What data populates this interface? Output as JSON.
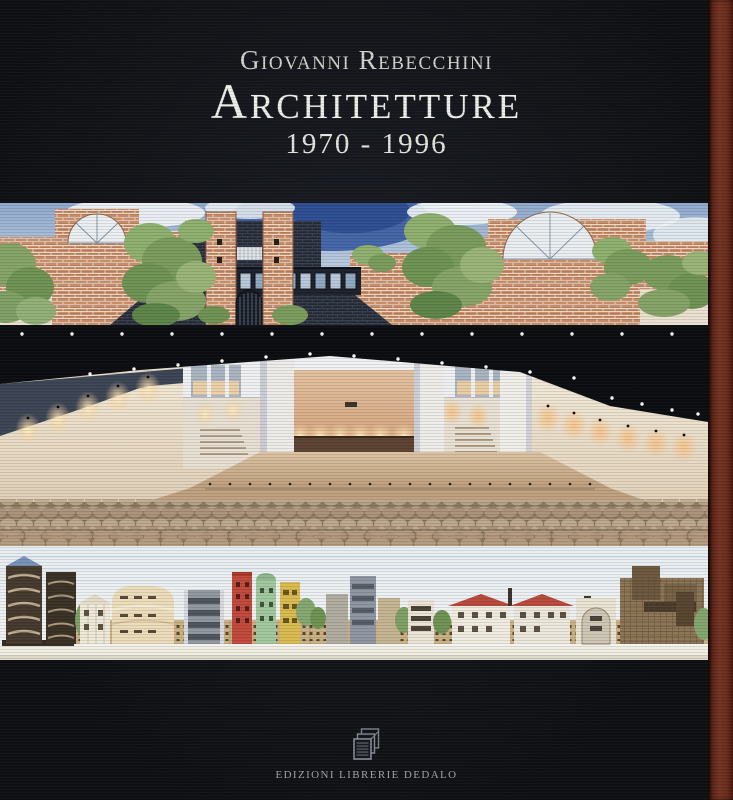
{
  "cover": {
    "author": "Giovanni Rebecchini",
    "title": "Architetture",
    "years": "1970 - 1996",
    "publisher": "EDIZIONI LIBRERIE DEDALO"
  },
  "artwork": {
    "top_strip_alt": "Watercolour elevation: long terracotta brick wall with twin towers, a dark glazed bridge over an arched gate, lunette windows and trees under a blue sky",
    "middle_strip_alt": "Photograph: auditorium interior with white walls, dark ceiling with spotlights, warm-lit stage and rows of seats",
    "bottom_strip_alt": "Watercolour street elevation of varied apartment buildings in brown, cream, red, green and yellow"
  },
  "colors": {
    "cover_black": "#16181d",
    "spine_brown": "#6b2d1c",
    "title_silver": "#eeeeea",
    "publisher_grey": "#a2a5ab"
  }
}
